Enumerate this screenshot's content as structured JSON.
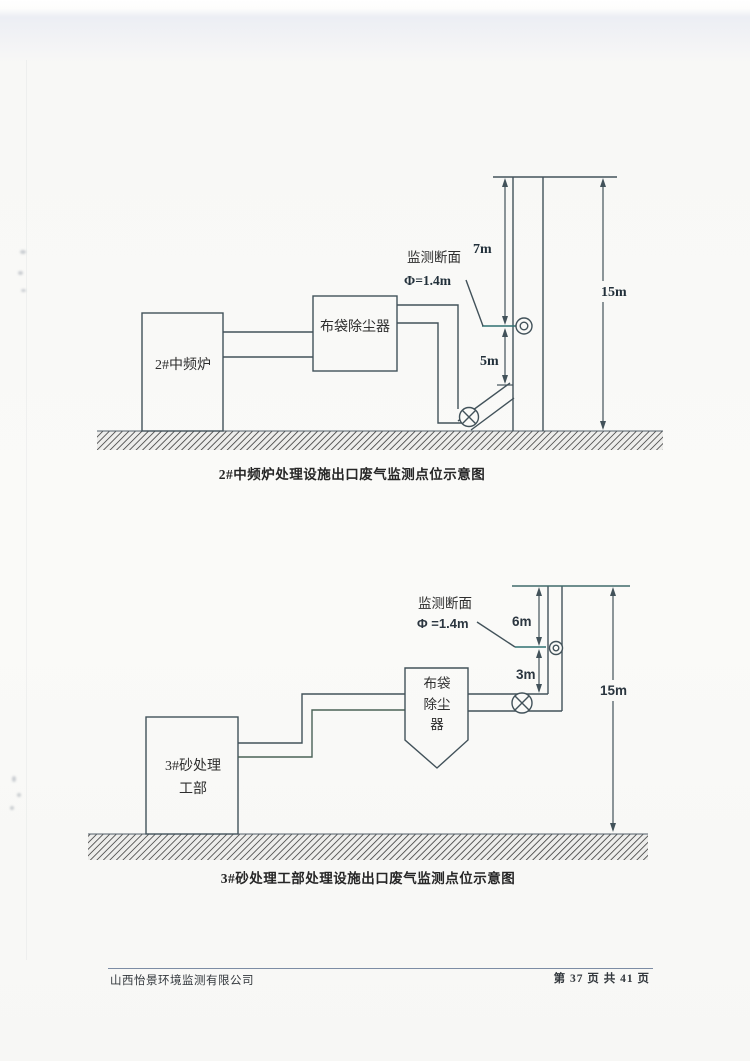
{
  "footer": {
    "company": "山西怡景环境监测有限公司",
    "page_label": "第 37 页 共 41 页"
  },
  "diagram1": {
    "source": "2#中频炉",
    "collector": "布袋除尘器",
    "section_line1": "监测断面",
    "section_line2": "Φ=1.4m",
    "dim_top": "7m",
    "dim_bottom": "5m",
    "dim_total": "15m",
    "caption": "2#中频炉处理设施出口废气监测点位示意图"
  },
  "diagram2": {
    "source_line1": "3#砂处理",
    "source_line2": "工部",
    "collector_line1": "布袋",
    "collector_line2": "除尘",
    "collector_line3": "器",
    "section_line1": "监测断面",
    "section_line2": "Φ =1.4m",
    "dim_top": "6m",
    "dim_bottom": "3m",
    "dim_total": "15m",
    "caption": "3#砂处理工部处理设施出口废气监测点位示意图"
  },
  "colors": {
    "line": "#42525a",
    "accent_teal": "#2f7070",
    "ground_hatch": "#474747"
  }
}
